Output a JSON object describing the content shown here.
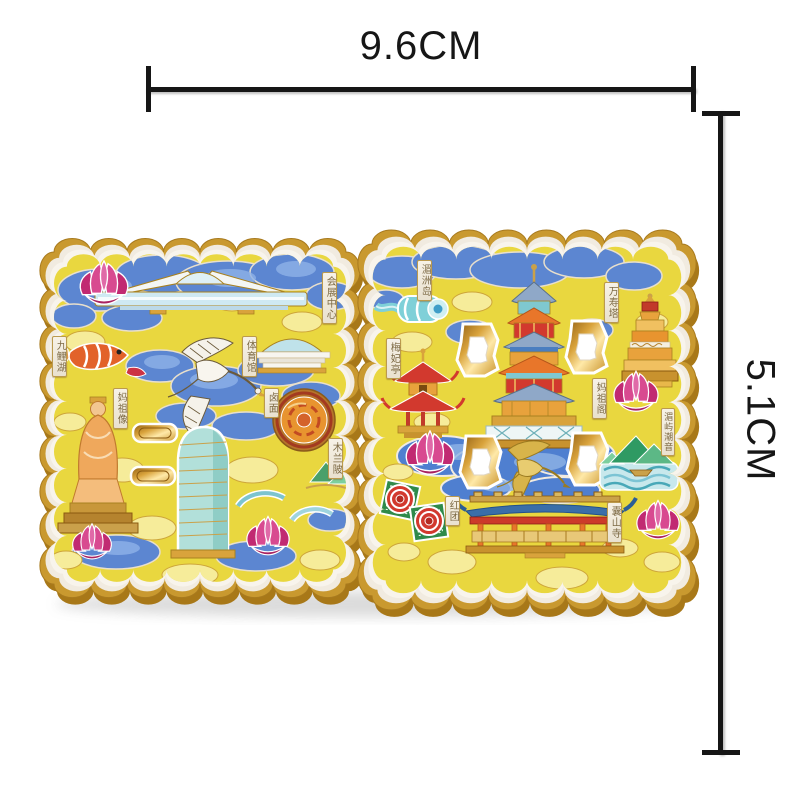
{
  "dimensions": {
    "width_label": "9.6CM",
    "height_label": "5.1CM"
  },
  "magnet": {
    "palette": {
      "gold": "#c9992f",
      "deep_gold": "#a87818",
      "cream": "#f1ebe0",
      "yellow": "#e9d73f",
      "pale_yellow": "#f6ec9a",
      "blue": "#5c86d1",
      "light_blue": "#8fb2e8",
      "teal": "#7fd0d8",
      "magenta": "#d63b86",
      "red": "#d2392e",
      "orange": "#e8a23c",
      "green": "#2f9a63",
      "white": "#f7f3ea"
    },
    "motifs": [
      "cloud-border",
      "lotus-flower",
      "flying-crane",
      "koi-fish",
      "convention-center-building",
      "stadium-dome",
      "noodle-dish",
      "mazu-statue",
      "glass-tower",
      "gold-slot-window",
      "arch-bridge",
      "ribbon-scroll",
      "meifei-pavilion",
      "mazu-pavilion-tower",
      "wanshou-pagoda",
      "openwork-cutout",
      "mountains-and-waves",
      "temple-hall",
      "hongtuan-cakes"
    ],
    "plaques": [
      {
        "id": "mazu-statue",
        "label": "妈祖像"
      },
      {
        "id": "convention-center",
        "label": "会展中心"
      },
      {
        "id": "nine-carp-lake",
        "label": "九鲤湖"
      },
      {
        "id": "gymnasium",
        "label": "体育馆"
      },
      {
        "id": "lumian-noodles",
        "label": "卤面"
      },
      {
        "id": "mulan-weir",
        "label": "木兰陂"
      },
      {
        "id": "meizhou-island",
        "label": "湄洲岛"
      },
      {
        "id": "meifei-pavilion",
        "label": "梅妃亭"
      },
      {
        "id": "wanshou-pagoda",
        "label": "万寿塔"
      },
      {
        "id": "mazu-pavilion",
        "label": "妈祖阁"
      },
      {
        "id": "meiyu-chaoyin",
        "label": "湄屿潮音"
      },
      {
        "id": "nangshan-temple",
        "label": "囊山寺"
      },
      {
        "id": "hongtuan",
        "label": "红团"
      }
    ]
  }
}
